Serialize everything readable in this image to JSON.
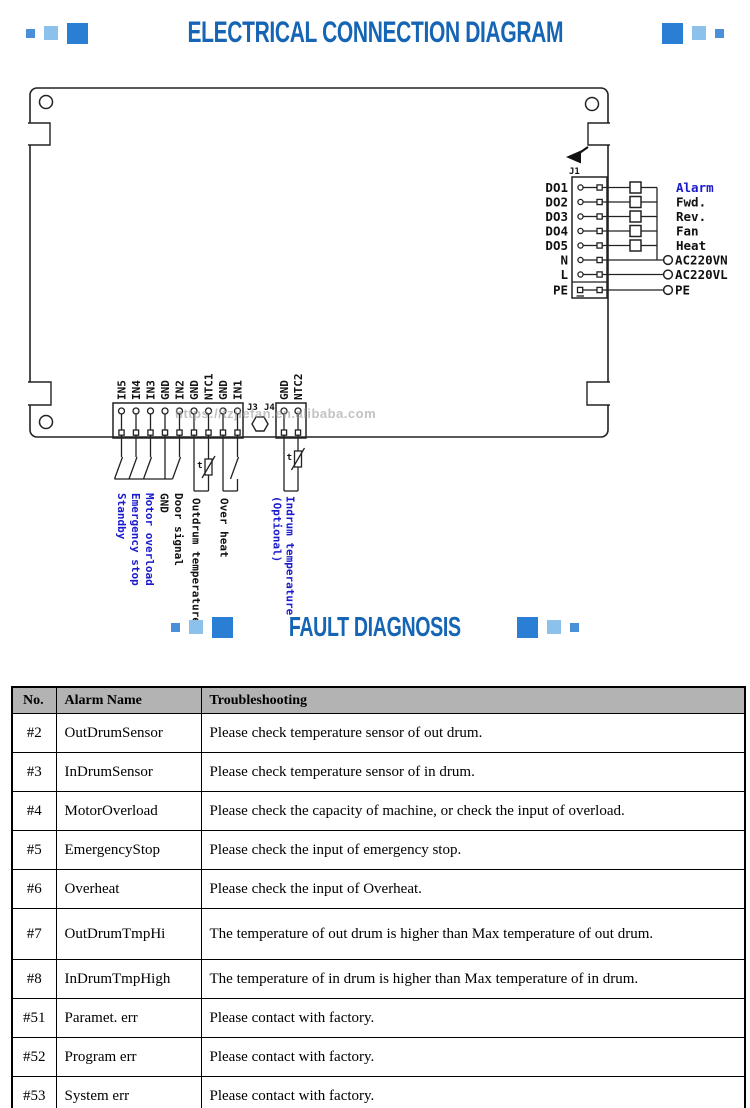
{
  "page": {
    "title1": "ELECTRICAL CONNECTION DIAGRAM",
    "title2": "FAULT DIAGNOSIS"
  },
  "colors": {
    "title_blue": "#1565b4",
    "square_dark": "#2a7fd4",
    "square_mid": "#8bc1ea",
    "square_small": "#4a90d9",
    "label_blue": "#1a1acc",
    "table_header_bg": "#b3b3b3"
  },
  "watermark": "https://tzjiefan.en.alibaba.com",
  "diagram": {
    "thermistor_label": "t",
    "j1": {
      "connector": "J1",
      "rows": [
        {
          "pin": "DO1",
          "right": "Alarm"
        },
        {
          "pin": "DO2",
          "right": "Fwd."
        },
        {
          "pin": "DO3",
          "right": "Rev."
        },
        {
          "pin": "DO4",
          "right": "Fan"
        },
        {
          "pin": "DO5",
          "right": "Heat"
        },
        {
          "pin": "N",
          "right": "AC220VN"
        },
        {
          "pin": "L",
          "right": "AC220VL"
        },
        {
          "pin": "PE",
          "right": "PE"
        }
      ]
    },
    "j3": {
      "connector": "J3",
      "pins": [
        "IN5",
        "IN4",
        "IN3",
        "GND",
        "IN2",
        "GND",
        "NTC1",
        "GND",
        "IN1"
      ]
    },
    "j4": {
      "connector": "J4",
      "pins": [
        "GND",
        "NTC2"
      ]
    },
    "bottom_labels": [
      {
        "text": "Standby"
      },
      {
        "text": "Emergency stop"
      },
      {
        "text": "Motor overload"
      },
      {
        "text": "GND"
      },
      {
        "text": "Door signal"
      },
      {
        "text": "Outdrum temperature"
      },
      {
        "text": "Over heat"
      },
      {
        "text": "Indrum temperature"
      },
      {
        "text": "(Optional)"
      }
    ]
  },
  "table": {
    "headers": [
      "No.",
      "Alarm Name",
      "Troubleshooting"
    ],
    "rows": [
      {
        "no": "#2",
        "name": "OutDrumSensor",
        "troubleshooting": "Please check temperature sensor of out drum."
      },
      {
        "no": "#3",
        "name": "InDrumSensor",
        "troubleshooting": "Please check temperature sensor of in drum."
      },
      {
        "no": "#4",
        "name": "MotorOverload",
        "troubleshooting": "Please check the capacity of machine, or check the input of overload."
      },
      {
        "no": "#5",
        "name": "EmergencyStop",
        "troubleshooting": "Please check the input of emergency stop."
      },
      {
        "no": "#6",
        "name": "Overheat",
        "troubleshooting": "Please check the input of Overheat."
      },
      {
        "no": "#7",
        "name": "OutDrumTmpHi",
        "troubleshooting": "The temperature of out drum is higher than Max temperature of out drum."
      },
      {
        "no": "#8",
        "name": "InDrumTmpHigh",
        "troubleshooting": "The temperature of in drum is higher than Max temperature of in drum."
      },
      {
        "no": "#51",
        "name": "Paramet. err",
        "troubleshooting": "Please contact with factory."
      },
      {
        "no": "#52",
        "name": "Program err",
        "troubleshooting": "Please contact with factory."
      },
      {
        "no": "#53",
        "name": "System err",
        "troubleshooting": "Please contact with factory."
      }
    ]
  }
}
